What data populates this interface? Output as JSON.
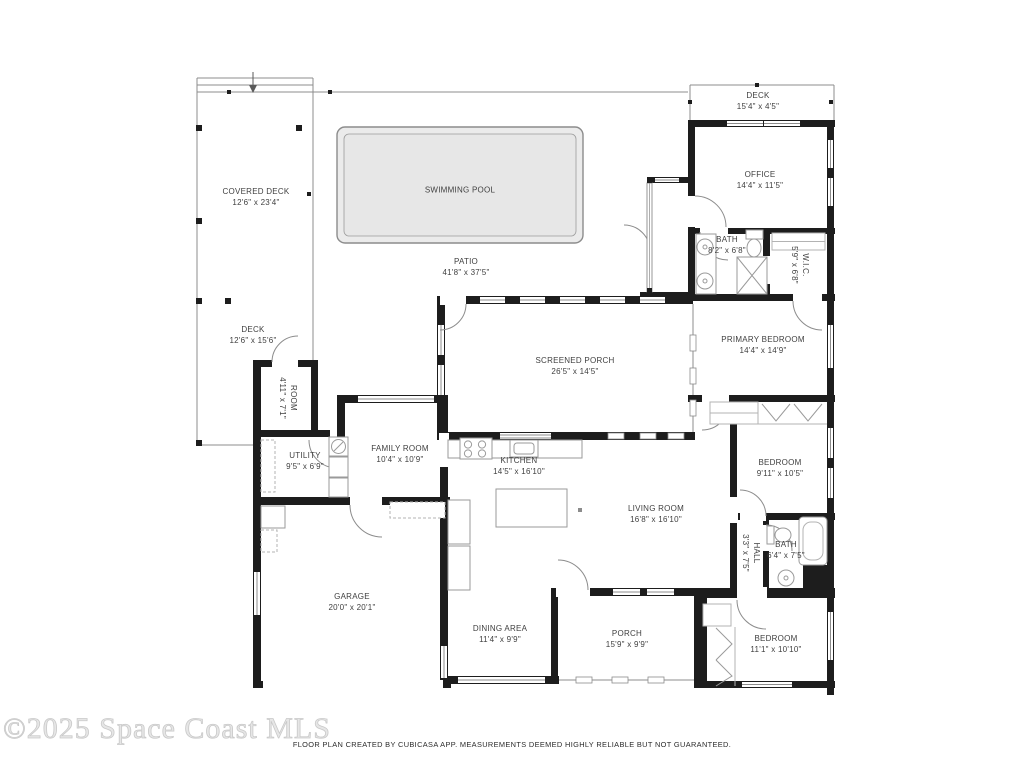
{
  "watermark": {
    "text": "©2025 Space Coast MLS"
  },
  "footer": {
    "disclaimer": "FLOOR PLAN CREATED BY CUBICASA APP. MEASUREMENTS DEEMED HIGHLY RELIABLE BUT NOT GUARANTEED."
  },
  "colors": {
    "wall": "#1d1d1d",
    "outline": "#8c8c8c",
    "pool_fill": "#ebebeb",
    "label_text": "#3f3f3f",
    "watermark": "#d9d9d9",
    "footer_text": "#2b2b2b"
  },
  "rooms": {
    "covered_deck": {
      "label": "COVERED DECK",
      "dims": "12'6\" x 23'4\""
    },
    "swimming_pool": {
      "label": "SWIMMING POOL",
      "dims": ""
    },
    "patio": {
      "label": "PATIO",
      "dims": "41'8\" x 37'5\""
    },
    "deck_top": {
      "label": "DECK",
      "dims": "15'4\" x 4'5\""
    },
    "office": {
      "label": "OFFICE",
      "dims": "14'4\" x 11'5\""
    },
    "bath_top": {
      "label": "BATH",
      "dims": "8'2\" x 6'8\""
    },
    "wic": {
      "label": "W.I.C.",
      "dims": "5'9\" x 6'8\""
    },
    "primary_bedroom": {
      "label": "PRIMARY BEDROOM",
      "dims": "14'4\" x 14'9\""
    },
    "screened_porch": {
      "label": "SCREENED PORCH",
      "dims": "26'5\" x 14'5\""
    },
    "deck_left": {
      "label": "DECK",
      "dims": "12'6\" x 15'6\""
    },
    "room": {
      "label": "ROOM",
      "dims": "4'11\" x 7'1\""
    },
    "utility": {
      "label": "UTILITY",
      "dims": "9'5\" x 6'9\""
    },
    "family_room": {
      "label": "FAMILY ROOM",
      "dims": "10'4\" x 10'9\""
    },
    "kitchen": {
      "label": "KITCHEN",
      "dims": "14'5\" x 16'10\""
    },
    "living_room": {
      "label": "LIVING ROOM",
      "dims": "16'8\" x 16'10\""
    },
    "bedroom_right": {
      "label": "BEDROOM",
      "dims": "9'11\" x 10'5\""
    },
    "hall": {
      "label": "HALL",
      "dims": "3'3\" x 7'5\""
    },
    "bath_right": {
      "label": "BATH",
      "dims": "6'4\" x 7'5\""
    },
    "garage": {
      "label": "GARAGE",
      "dims": "20'0\" x 20'1\""
    },
    "dining_area": {
      "label": "DINING AREA",
      "dims": "11'4\" x 9'9\""
    },
    "porch": {
      "label": "PORCH",
      "dims": "15'9\" x 9'9\""
    },
    "bedroom_bottom": {
      "label": "BEDROOM",
      "dims": "11'1\" x 10'10\""
    }
  }
}
